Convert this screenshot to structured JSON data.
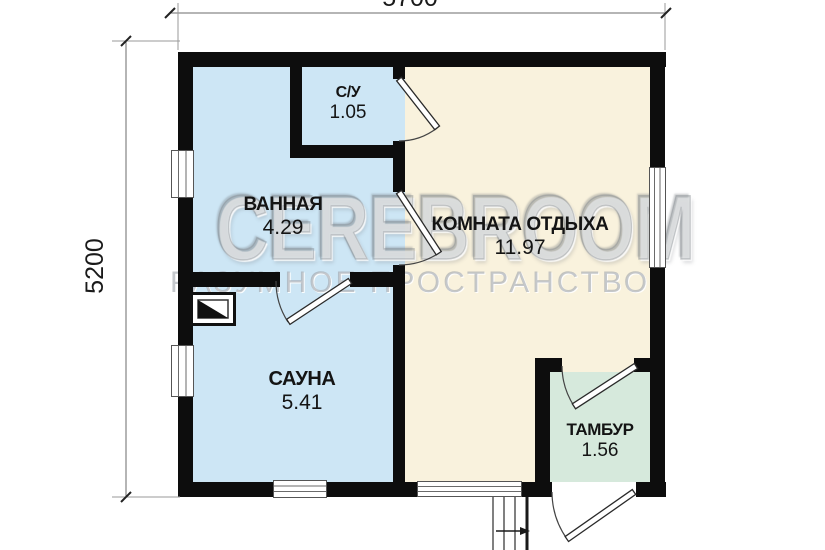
{
  "dimensions": {
    "top": "5700",
    "left": "5200"
  },
  "rooms": [
    {
      "name": "ВАННАЯ",
      "area": "4.29"
    },
    {
      "name": "С/У",
      "area": "1.05"
    },
    {
      "name": "КОМНАТА ОТДЫХА",
      "area": "11.97"
    },
    {
      "name": "САУНА",
      "area": "5.41"
    },
    {
      "name": "ТАМБУР",
      "area": "1.56"
    }
  ],
  "watermark": {
    "title": "CEREBROOM",
    "tagline": "РАЗУМНОЕ ПРОСТРАНСТВО"
  },
  "colors": {
    "wet_rooms": "#cde6f5",
    "rest_room": "#f9f2dd",
    "tambour": "#d6e9dc",
    "walls": "#0d0d0d"
  }
}
